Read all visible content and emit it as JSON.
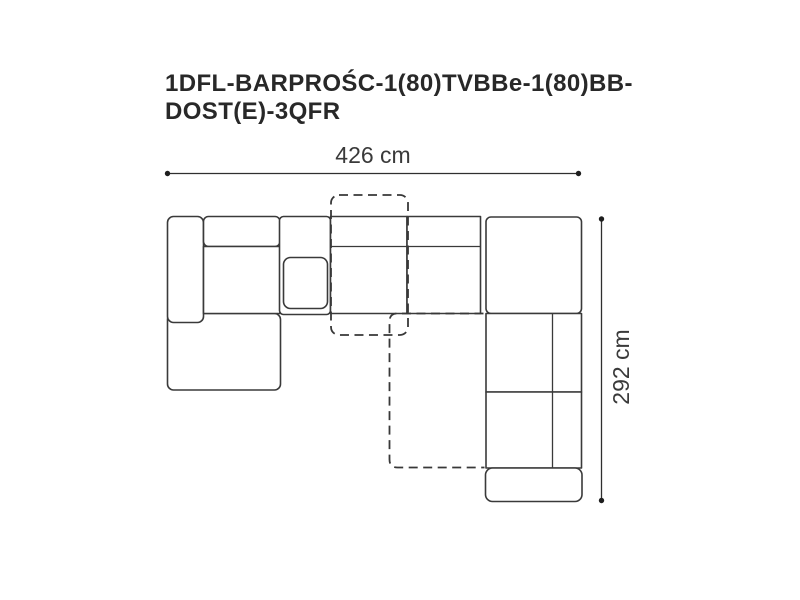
{
  "title": {
    "line1": "1DFL-BARPROŚC-1(80)TVBBe-1(80)BB-",
    "line2": "DOST(E)-3QFR"
  },
  "dimensions": {
    "width_label": "426 cm",
    "height_label": "292 cm"
  },
  "colors": {
    "background": "#ffffff",
    "line": "#3a3a3a",
    "title_text": "#282828",
    "dimension_text": "#3a3a3a"
  }
}
